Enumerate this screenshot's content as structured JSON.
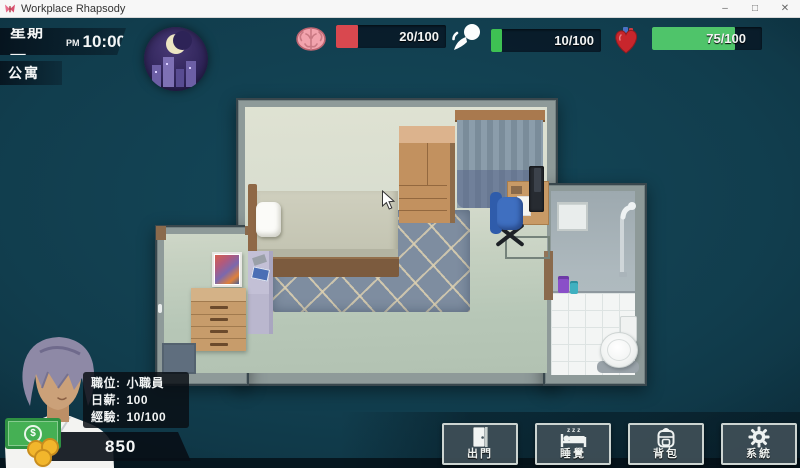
{
  "window": {
    "title": "Workplace Rhapsody",
    "controls": {
      "minimize": "–",
      "maximize": "□",
      "close": "✕"
    }
  },
  "hud": {
    "day": "星期一",
    "meridiem": "PM",
    "time": "10:00",
    "location": "公寓",
    "money": "850"
  },
  "stats": [
    {
      "icon": "brain-icon",
      "value": "20/100",
      "pct": 20,
      "fill": "#d9484f"
    },
    {
      "icon": "energy-icon",
      "value": "10/100",
      "pct": 10,
      "fill": "#3ec153"
    },
    {
      "icon": "heart-icon",
      "value": "75/100",
      "pct": 75,
      "fill": "#4fc46a"
    }
  ],
  "player": {
    "rows": [
      {
        "label": "職位:",
        "value": "小職員"
      },
      {
        "label": "日薪:",
        "value": "100"
      },
      {
        "label": "經驗:",
        "value": "10/100"
      }
    ],
    "money_symbol": "$"
  },
  "actions": [
    {
      "label": "出門",
      "icon": "door-icon"
    },
    {
      "label": "睡覺",
      "icon": "bed-icon"
    },
    {
      "label": "背包",
      "icon": "backpack-icon"
    },
    {
      "label": "系統",
      "icon": "gear-icon"
    }
  ],
  "colors": {
    "stat_track": "#0a1a28",
    "bar_red": "#d9484f",
    "bar_green": "#3ec153",
    "money_green": "#45b054"
  }
}
